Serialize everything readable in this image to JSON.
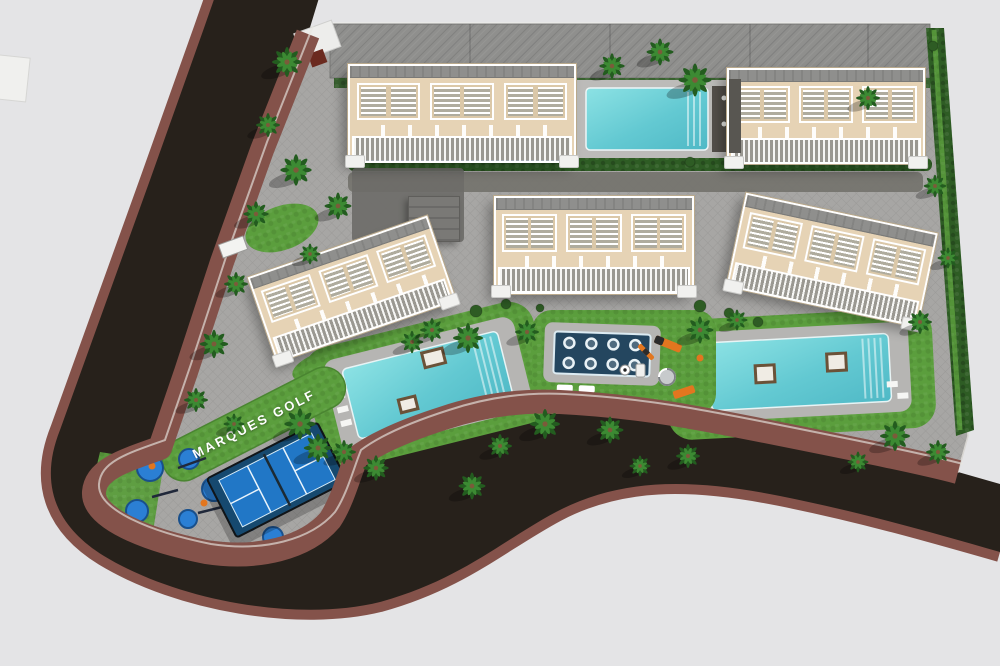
{
  "scene": {
    "site_label": "MARQUES GOLF",
    "description": "Aerial 3D render of the Marques Golf residential development: five beige apartment blocks with white roof pergolas and balconies, three turquoise swimming pools, a navy spa with hydro loungers, a padel court, a children's playground, an outdoor gym and palm-lined streets bounded by a dark asphalt road with brown sidewalks.",
    "palette": {
      "background": "#e4e4e6",
      "road": "#27211b",
      "sidewalk": "#84524a",
      "pavement": "#a7a6a4",
      "lawn": "#5b9e3d",
      "hedge": "#2e5c24",
      "building": "#e6d3b5",
      "pool": "#63c9d2",
      "spa": "#24465f",
      "padel": "#2177c6",
      "orange": "#e2761f",
      "gym": "#2b7fd4",
      "roof": "#8f8f8d"
    },
    "features": {
      "buildings": [
        "north-west block",
        "north-east block",
        "west block",
        "central block",
        "east block"
      ],
      "pools": [
        "north pool",
        "west pool",
        "east pool",
        "central spa"
      ],
      "amenities": [
        "padel court",
        "playground",
        "outdoor gym",
        "palm gardens"
      ]
    }
  }
}
